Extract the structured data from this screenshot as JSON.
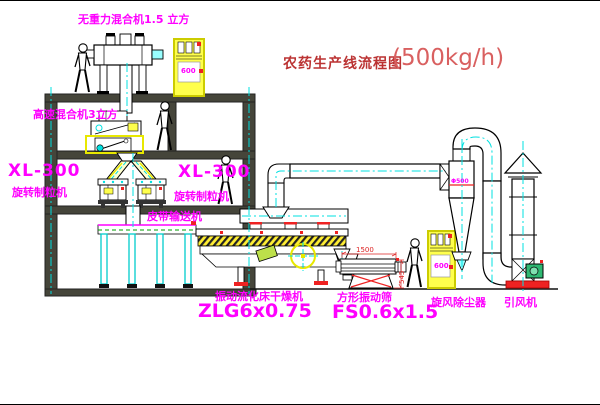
{
  "title": {
    "zh": "农药生产线流程图",
    "capacity": "(500kg/h)"
  },
  "labels": {
    "top_mixer": "无重力混合机1.5 立方",
    "high_speed_mixer": "高速混合机3立方",
    "granulator_model": "XL-300",
    "granulator_name": "旋转制粒机",
    "belt_conveyor": "皮带输送机",
    "dryer_name": "振动流化床干燥机",
    "dryer_model": "ZLG6x0.75",
    "screen_name": "方形振动筛",
    "screen_model": "FS0.6x1.5",
    "cyclone": "旋风除尘器",
    "fan": "引风机",
    "cabinet_display": "600",
    "cyclone_dim": "Φ500"
  },
  "dimensions": {
    "screen_length": "1500",
    "screen_height": "545"
  },
  "colors": {
    "label_magenta": "#ff00ff",
    "title_red": "#bb3333",
    "detail_red": "#ee2222",
    "centerline_cyan": "#00e0e0",
    "machine_yellow": "#ffff4d",
    "structure_dark": "#45453a"
  }
}
